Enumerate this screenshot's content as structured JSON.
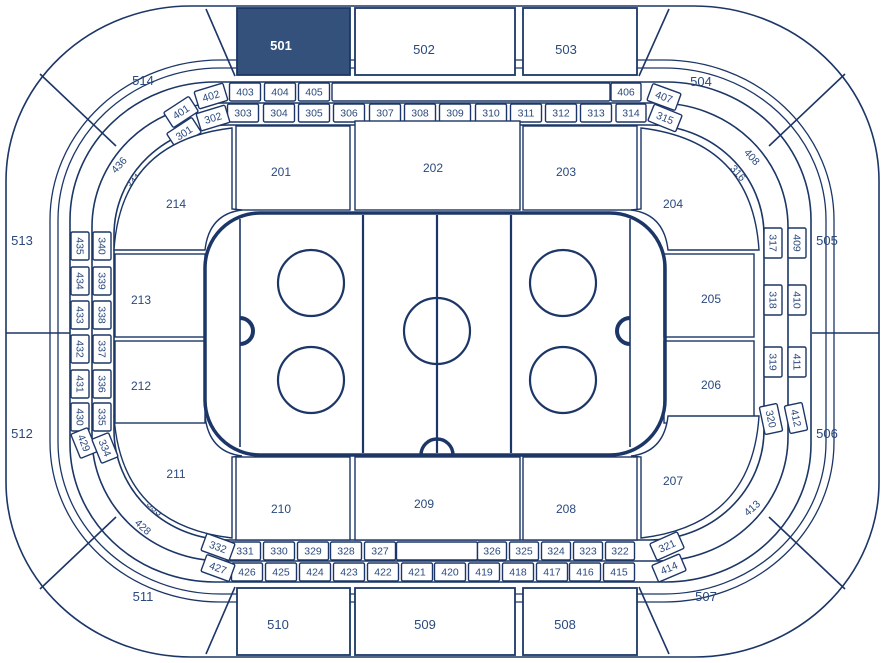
{
  "colors": {
    "line": "#1c3667",
    "text": "#2a497e",
    "highlight_fill": "#33517a",
    "highlight_text": "#ffffff",
    "background": "#ffffff"
  },
  "arena": {
    "selected_section": "501",
    "upper_sections": [
      {
        "label": "501",
        "type": "box",
        "x": 237,
        "y": 8,
        "w": 113,
        "h": 67,
        "lx": 281,
        "ly": 46,
        "selected": true
      },
      {
        "label": "502",
        "type": "box",
        "x": 355,
        "y": 8,
        "w": 160,
        "h": 67,
        "lx": 424,
        "ly": 50
      },
      {
        "label": "503",
        "type": "box",
        "x": 523,
        "y": 8,
        "w": 114,
        "h": 67,
        "lx": 566,
        "ly": 50
      },
      {
        "label": "504",
        "type": "text",
        "lx": 701,
        "ly": 82
      },
      {
        "label": "505",
        "type": "text",
        "lx": 827,
        "ly": 241
      },
      {
        "label": "506",
        "type": "text",
        "lx": 827,
        "ly": 434
      },
      {
        "label": "507",
        "type": "text",
        "lx": 706,
        "ly": 597
      },
      {
        "label": "508",
        "type": "box",
        "x": 523,
        "y": 588,
        "w": 114,
        "h": 67,
        "lx": 565,
        "ly": 625
      },
      {
        "label": "509",
        "type": "box",
        "x": 355,
        "y": 588,
        "w": 160,
        "h": 67,
        "lx": 425,
        "ly": 625
      },
      {
        "label": "510",
        "type": "box",
        "x": 237,
        "y": 588,
        "w": 113,
        "h": 67,
        "lx": 278,
        "ly": 625
      },
      {
        "label": "511",
        "type": "text",
        "lx": 143,
        "ly": 597
      },
      {
        "label": "512",
        "type": "text",
        "lx": 22,
        "ly": 434
      },
      {
        "label": "513",
        "type": "text",
        "lx": 22,
        "ly": 241
      },
      {
        "label": "514",
        "type": "text",
        "lx": 143,
        "ly": 81
      }
    ],
    "mid_sections": [
      {
        "label": "201",
        "type": "box",
        "x": 236,
        "y": 126,
        "w": 114,
        "h": 84,
        "lx": 281,
        "ly": 172
      },
      {
        "label": "202",
        "type": "box",
        "x": 355,
        "y": 121,
        "w": 165,
        "h": 89,
        "lx": 433,
        "ly": 168
      },
      {
        "label": "203",
        "type": "box",
        "x": 523,
        "y": 126,
        "w": 114,
        "h": 84,
        "lx": 566,
        "ly": 172
      },
      {
        "label": "204",
        "type": "corner",
        "path": "M641,128 Q752,141 759,250 L668,250 Q664,214 631,210 L641,209 Z",
        "lx": 673,
        "ly": 204
      },
      {
        "label": "205",
        "type": "box",
        "x": 664,
        "y": 254,
        "w": 90,
        "h": 83,
        "lx": 711,
        "ly": 299
      },
      {
        "label": "206",
        "type": "box",
        "x": 664,
        "y": 341,
        "w": 90,
        "h": 82,
        "lx": 711,
        "ly": 385
      },
      {
        "label": "207",
        "type": "corner",
        "path": "M641,538 Q752,525 759,416 L668,416 Q664,452 631,456 L641,457 Z",
        "lx": 673,
        "ly": 481
      },
      {
        "label": "208",
        "type": "box",
        "x": 523,
        "y": 457,
        "w": 114,
        "h": 83,
        "lx": 566,
        "ly": 509
      },
      {
        "label": "209",
        "type": "box",
        "x": 355,
        "y": 457,
        "w": 165,
        "h": 83,
        "lx": 424,
        "ly": 504
      },
      {
        "label": "210",
        "type": "box",
        "x": 236,
        "y": 457,
        "w": 114,
        "h": 83,
        "lx": 281,
        "ly": 509
      },
      {
        "label": "211",
        "type": "corner",
        "path": "M232,538 Q121,525 114,416 L205,416 Q209,452 242,456 L232,457 Z",
        "lx": 176,
        "ly": 474
      },
      {
        "label": "212",
        "type": "box",
        "x": 115,
        "y": 341,
        "w": 90,
        "h": 82,
        "lx": 141,
        "ly": 386
      },
      {
        "label": "213",
        "type": "box",
        "x": 115,
        "y": 254,
        "w": 90,
        "h": 83,
        "lx": 141,
        "ly": 300
      },
      {
        "label": "214",
        "type": "corner",
        "path": "M232,128 Q121,141 114,250 L205,250 Q209,214 242,210 L232,209 Z",
        "lx": 176,
        "ly": 204
      }
    ],
    "ring_boxes": [
      {
        "label": "403",
        "cx": 245,
        "cy": 92,
        "w": 31,
        "rot": 0
      },
      {
        "label": "404",
        "cx": 280,
        "cy": 92,
        "w": 31,
        "rot": 0
      },
      {
        "label": "405",
        "cx": 314,
        "cy": 92,
        "w": 31,
        "rot": 0
      },
      {
        "label": "",
        "cx": 471,
        "cy": 92,
        "w": 278,
        "rot": 0
      },
      {
        "label": "406",
        "cx": 626,
        "cy": 92,
        "w": 30,
        "rot": 0
      },
      {
        "label": "303",
        "cx": 243,
        "cy": 113,
        "w": 31,
        "rot": 0
      },
      {
        "label": "304",
        "cx": 279,
        "cy": 113,
        "w": 31,
        "rot": 0
      },
      {
        "label": "305",
        "cx": 314,
        "cy": 113,
        "w": 31,
        "rot": 0
      },
      {
        "label": "306",
        "cx": 349,
        "cy": 113,
        "w": 31,
        "rot": 0
      },
      {
        "label": "307",
        "cx": 385,
        "cy": 113,
        "w": 31,
        "rot": 0
      },
      {
        "label": "308",
        "cx": 420,
        "cy": 113,
        "w": 31,
        "rot": 0
      },
      {
        "label": "309",
        "cx": 455,
        "cy": 113,
        "w": 31,
        "rot": 0
      },
      {
        "label": "310",
        "cx": 491,
        "cy": 113,
        "w": 31,
        "rot": 0
      },
      {
        "label": "311",
        "cx": 526,
        "cy": 113,
        "w": 31,
        "rot": 0
      },
      {
        "label": "312",
        "cx": 561,
        "cy": 113,
        "w": 31,
        "rot": 0
      },
      {
        "label": "313",
        "cx": 596,
        "cy": 113,
        "w": 31,
        "rot": 0
      },
      {
        "label": "314",
        "cx": 631,
        "cy": 113,
        "w": 30,
        "rot": 0
      },
      {
        "label": "402",
        "cx": 211,
        "cy": 96,
        "w": 30,
        "rot": -17
      },
      {
        "label": "401",
        "cx": 181,
        "cy": 112,
        "w": 30,
        "rot": -33
      },
      {
        "label": "302",
        "cx": 213,
        "cy": 118,
        "w": 30,
        "rot": -17
      },
      {
        "label": "301",
        "cx": 184,
        "cy": 133,
        "w": 30,
        "rot": -33
      },
      {
        "label": "436",
        "cx": 119,
        "cy": 165,
        "rot": -48,
        "nobox": true
      },
      {
        "label": "341",
        "cx": 134,
        "cy": 181,
        "rot": -48,
        "nobox": true
      },
      {
        "label": "407",
        "cx": 664,
        "cy": 97,
        "w": 30,
        "rot": 20
      },
      {
        "label": "315",
        "cx": 665,
        "cy": 118,
        "w": 30,
        "rot": 22
      },
      {
        "label": "408",
        "cx": 752,
        "cy": 157,
        "rot": 48,
        "nobox": true
      },
      {
        "label": "316",
        "cx": 738,
        "cy": 173,
        "rot": 48,
        "nobox": true
      },
      {
        "label": "435",
        "cx": 80,
        "cy": 246,
        "w": 28,
        "rot": 90
      },
      {
        "label": "434",
        "cx": 80,
        "cy": 281,
        "w": 28,
        "rot": 90
      },
      {
        "label": "433",
        "cx": 80,
        "cy": 315,
        "w": 28,
        "rot": 90
      },
      {
        "label": "432",
        "cx": 80,
        "cy": 349,
        "w": 28,
        "rot": 90
      },
      {
        "label": "431",
        "cx": 80,
        "cy": 384,
        "w": 28,
        "rot": 90
      },
      {
        "label": "430",
        "cx": 80,
        "cy": 417,
        "w": 28,
        "rot": 90
      },
      {
        "label": "429",
        "cx": 84,
        "cy": 443,
        "w": 26,
        "rot": 68
      },
      {
        "label": "340",
        "cx": 102,
        "cy": 246,
        "w": 28,
        "rot": 90
      },
      {
        "label": "339",
        "cx": 102,
        "cy": 281,
        "w": 28,
        "rot": 90
      },
      {
        "label": "338",
        "cx": 102,
        "cy": 315,
        "w": 28,
        "rot": 90
      },
      {
        "label": "337",
        "cx": 102,
        "cy": 349,
        "w": 28,
        "rot": 90
      },
      {
        "label": "336",
        "cx": 102,
        "cy": 384,
        "w": 28,
        "rot": 90
      },
      {
        "label": "335",
        "cx": 102,
        "cy": 417,
        "w": 28,
        "rot": 90
      },
      {
        "label": "334",
        "cx": 105,
        "cy": 448,
        "w": 26,
        "rot": 68
      },
      {
        "label": "317",
        "cx": 773,
        "cy": 243,
        "w": 30,
        "rot": 90
      },
      {
        "label": "318",
        "cx": 773,
        "cy": 300,
        "w": 30,
        "rot": 90
      },
      {
        "label": "319",
        "cx": 773,
        "cy": 362,
        "w": 30,
        "rot": 90
      },
      {
        "label": "320",
        "cx": 771,
        "cy": 419,
        "w": 28,
        "rot": 78
      },
      {
        "label": "409",
        "cx": 797,
        "cy": 243,
        "w": 30,
        "rot": 90
      },
      {
        "label": "410",
        "cx": 797,
        "cy": 300,
        "w": 30,
        "rot": 90
      },
      {
        "label": "411",
        "cx": 797,
        "cy": 362,
        "w": 30,
        "rot": 90
      },
      {
        "label": "412",
        "cx": 796,
        "cy": 418,
        "w": 28,
        "rot": 78
      },
      {
        "label": "413",
        "cx": 752,
        "cy": 508,
        "rot": -42,
        "nobox": true
      },
      {
        "label": "331",
        "cx": 245,
        "cy": 551,
        "w": 31,
        "rot": 0
      },
      {
        "label": "330",
        "cx": 279,
        "cy": 551,
        "w": 31,
        "rot": 0
      },
      {
        "label": "329",
        "cx": 313,
        "cy": 551,
        "w": 31,
        "rot": 0
      },
      {
        "label": "328",
        "cx": 346,
        "cy": 551,
        "w": 31,
        "rot": 0
      },
      {
        "label": "327",
        "cx": 380,
        "cy": 551,
        "w": 31,
        "rot": 0
      },
      {
        "label": "",
        "cx": 437,
        "cy": 551,
        "w": 81,
        "rot": 0
      },
      {
        "label": "326",
        "cx": 492,
        "cy": 551,
        "w": 29,
        "rot": 0
      },
      {
        "label": "325",
        "cx": 524,
        "cy": 551,
        "w": 29,
        "rot": 0
      },
      {
        "label": "324",
        "cx": 556,
        "cy": 551,
        "w": 29,
        "rot": 0
      },
      {
        "label": "323",
        "cx": 588,
        "cy": 551,
        "w": 29,
        "rot": 0
      },
      {
        "label": "322",
        "cx": 620,
        "cy": 551,
        "w": 29,
        "rot": 0
      },
      {
        "label": "321",
        "cx": 667,
        "cy": 546,
        "w": 30,
        "rot": -24
      },
      {
        "label": "426",
        "cx": 247,
        "cy": 572,
        "w": 31,
        "rot": 0
      },
      {
        "label": "425",
        "cx": 281,
        "cy": 572,
        "w": 31,
        "rot": 0
      },
      {
        "label": "424",
        "cx": 315,
        "cy": 572,
        "w": 31,
        "rot": 0
      },
      {
        "label": "423",
        "cx": 349,
        "cy": 572,
        "w": 31,
        "rot": 0
      },
      {
        "label": "422",
        "cx": 383,
        "cy": 572,
        "w": 31,
        "rot": 0
      },
      {
        "label": "421",
        "cx": 417,
        "cy": 572,
        "w": 31,
        "rot": 0
      },
      {
        "label": "420",
        "cx": 450,
        "cy": 572,
        "w": 31,
        "rot": 0
      },
      {
        "label": "419",
        "cx": 484,
        "cy": 572,
        "w": 31,
        "rot": 0
      },
      {
        "label": "418",
        "cx": 518,
        "cy": 572,
        "w": 31,
        "rot": 0
      },
      {
        "label": "417",
        "cx": 552,
        "cy": 572,
        "w": 31,
        "rot": 0
      },
      {
        "label": "416",
        "cx": 585,
        "cy": 572,
        "w": 31,
        "rot": 0
      },
      {
        "label": "415",
        "cx": 619,
        "cy": 572,
        "w": 31,
        "rot": 0
      },
      {
        "label": "414",
        "cx": 669,
        "cy": 568,
        "w": 30,
        "rot": -23
      },
      {
        "label": "333",
        "cx": 155,
        "cy": 508,
        "rot": 42,
        "nobox": true
      },
      {
        "label": "428",
        "cx": 143,
        "cy": 527,
        "rot": 42,
        "nobox": true
      },
      {
        "label": "332",
        "cx": 218,
        "cy": 547,
        "w": 30,
        "rot": 20
      },
      {
        "label": "427",
        "cx": 218,
        "cy": 568,
        "w": 30,
        "rot": 20
      }
    ]
  }
}
